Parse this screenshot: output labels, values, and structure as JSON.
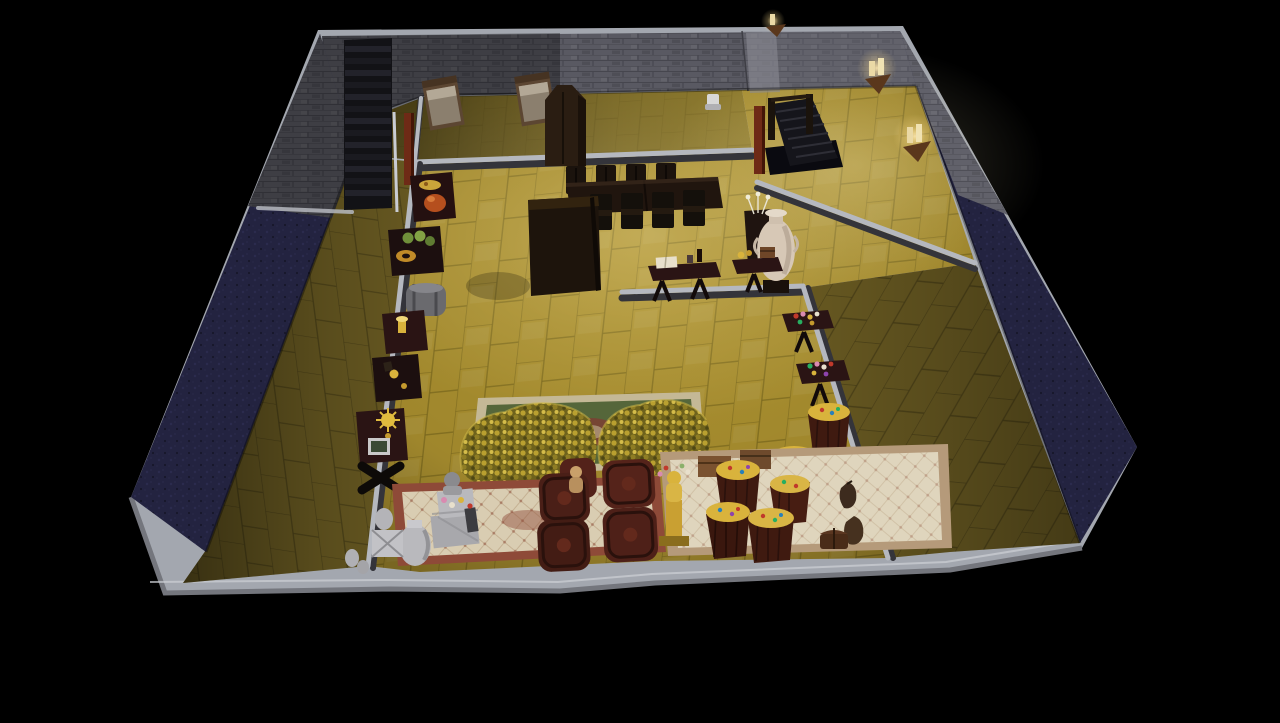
{
  "scene": {
    "title": "Dollhouse cutaway view - basement treasure vault",
    "style": "life-simulation game, isometric cutaway interior on black void",
    "view": "overhead three-quarter cutaway, walls cut to slab band"
  },
  "palette": {
    "bg": "#000000",
    "slab": "#a3a7af",
    "slab-dark": "#74767d",
    "slab-light": "#cdd0d6",
    "stone": "#595962",
    "stone-dark": "#46464e",
    "stone-light": "#7b7b85",
    "navy": "#232340",
    "navy-light": "#34345c",
    "trim": "#b5b8bf",
    "floor-bright": "#ad9230",
    "floor-line": "#7d6a1e",
    "floor-mid": "#8f7a28",
    "floor-dim": "#6a5b22",
    "floor-dim-line": "#4a3f16",
    "wood-dark": "#1d140c",
    "wood-mid": "#3a2a1c",
    "wood-red": "#6e2a16",
    "maroon": "#2a1414",
    "gold": "#d9b33c",
    "gold-dark": "#8a6d1d",
    "gold-light": "#f0d878",
    "cream": "#d9cdb2",
    "cream-dark": "#b59a7a",
    "rug-red": "#8e4a38",
    "rug-green": "#55663a",
    "statue": "#b9b9bd",
    "statue-dark": "#8e8e92",
    "barrel": "#3f1a10",
    "barrel-dark": "#1d0c06",
    "barrel-mid": "#63291c",
    "candle": "#ead9a6"
  },
  "rooms": {
    "stair_room": {
      "label": "stair landing room",
      "floor": "dim gold tile"
    },
    "bed_room": {
      "label": "bunk room with two worn beds",
      "floor": "gold tile"
    },
    "main_hall": {
      "label": "main vault hall",
      "floor": "bright gold tile"
    },
    "left_room": {
      "label": "empty west room",
      "floor": "dark olive tile"
    },
    "right_room": {
      "label": "empty east room",
      "floor": "dark olive tile"
    }
  },
  "objects": {
    "staircase_up": {
      "label": "dark staircase ascending along north-west wall"
    },
    "stairwell_down": {
      "label": "stairwell opening descending into floor"
    },
    "door_frame_left": {
      "label": "red wood door frame"
    },
    "door_frame_stairwell": {
      "label": "red wood stairwell post"
    },
    "bed_1": {
      "label": "worn single bed"
    },
    "bed_2": {
      "label": "worn single bed"
    },
    "wardrobe": {
      "label": "dark wood wardrobe with pointed top"
    },
    "toilet_stool": {
      "label": "small white stool"
    },
    "dining_set": {
      "label": "two dark dining tables with eight chairs"
    },
    "tall_cabinet": {
      "label": "tall dark storage cabinet"
    },
    "amphora": {
      "label": "large cream ceramic amphora on pedestal"
    },
    "flower_cabinet": {
      "label": "dark cabinet with white flower sprays"
    },
    "table_book": {
      "label": "pedestal table with open book, bottle and glass"
    },
    "table_gold_chest": {
      "label": "pedestal table with gold trinkets and small chest"
    },
    "table_roast": {
      "label": "display table with roast and platter"
    },
    "table_produce": {
      "label": "display table with produce and pastry wreath"
    },
    "keg_chest": {
      "label": "round metal keg chest"
    },
    "table_goblet": {
      "label": "pedestal table with gold goblet"
    },
    "table_trinkets": {
      "label": "pedestal table with gold trinkets"
    },
    "table_sunburst": {
      "label": "pedestal table with gold sunburst and framed relic"
    },
    "x_pedestal": {
      "label": "dark cross pedestal"
    },
    "gem_table_1": {
      "label": "table scattered with cut gems"
    },
    "gem_table_2": {
      "label": "table scattered with cut gems"
    },
    "gold_pile_left": {
      "label": "huge mound of gold coins"
    },
    "gold_pile_right": {
      "label": "huge mound of gold coins"
    },
    "tapestry_rug": {
      "label": "green tapestry rug under gold piles"
    },
    "persian_rug_left": {
      "label": "cream persian rug with red border"
    },
    "persian_rug_right": {
      "label": "cream ornate rug"
    },
    "statuary": {
      "label": "grey stone urns, crates and bust pedestal"
    },
    "wine_barrels": {
      "label": "four large dark wine barrels"
    },
    "gold_barrels": {
      "label": "upright barrels brimming with gold and gems"
    },
    "gold_statue": {
      "label": "gold figurine on ornate column"
    },
    "figurine": {
      "label": "tan figurine seated on barrel"
    },
    "money_pouches": {
      "label": "two leather coin pouches"
    },
    "small_chest": {
      "label": "small wooden chest"
    },
    "crates": {
      "label": "two banded wooden crates"
    },
    "sconce_1": {
      "label": "wall candle sconce"
    },
    "sconce_2": {
      "label": "wall candle sconce"
    },
    "sconce_3": {
      "label": "wall candle sconce"
    }
  },
  "counts": {
    "beds": 2,
    "dining_chairs": 8,
    "gold_piles": 2,
    "wine_barrels": 4,
    "gold_filled_barrels": 7,
    "gem_tables": 2,
    "candle_sconces": 3,
    "rugs": 3
  }
}
